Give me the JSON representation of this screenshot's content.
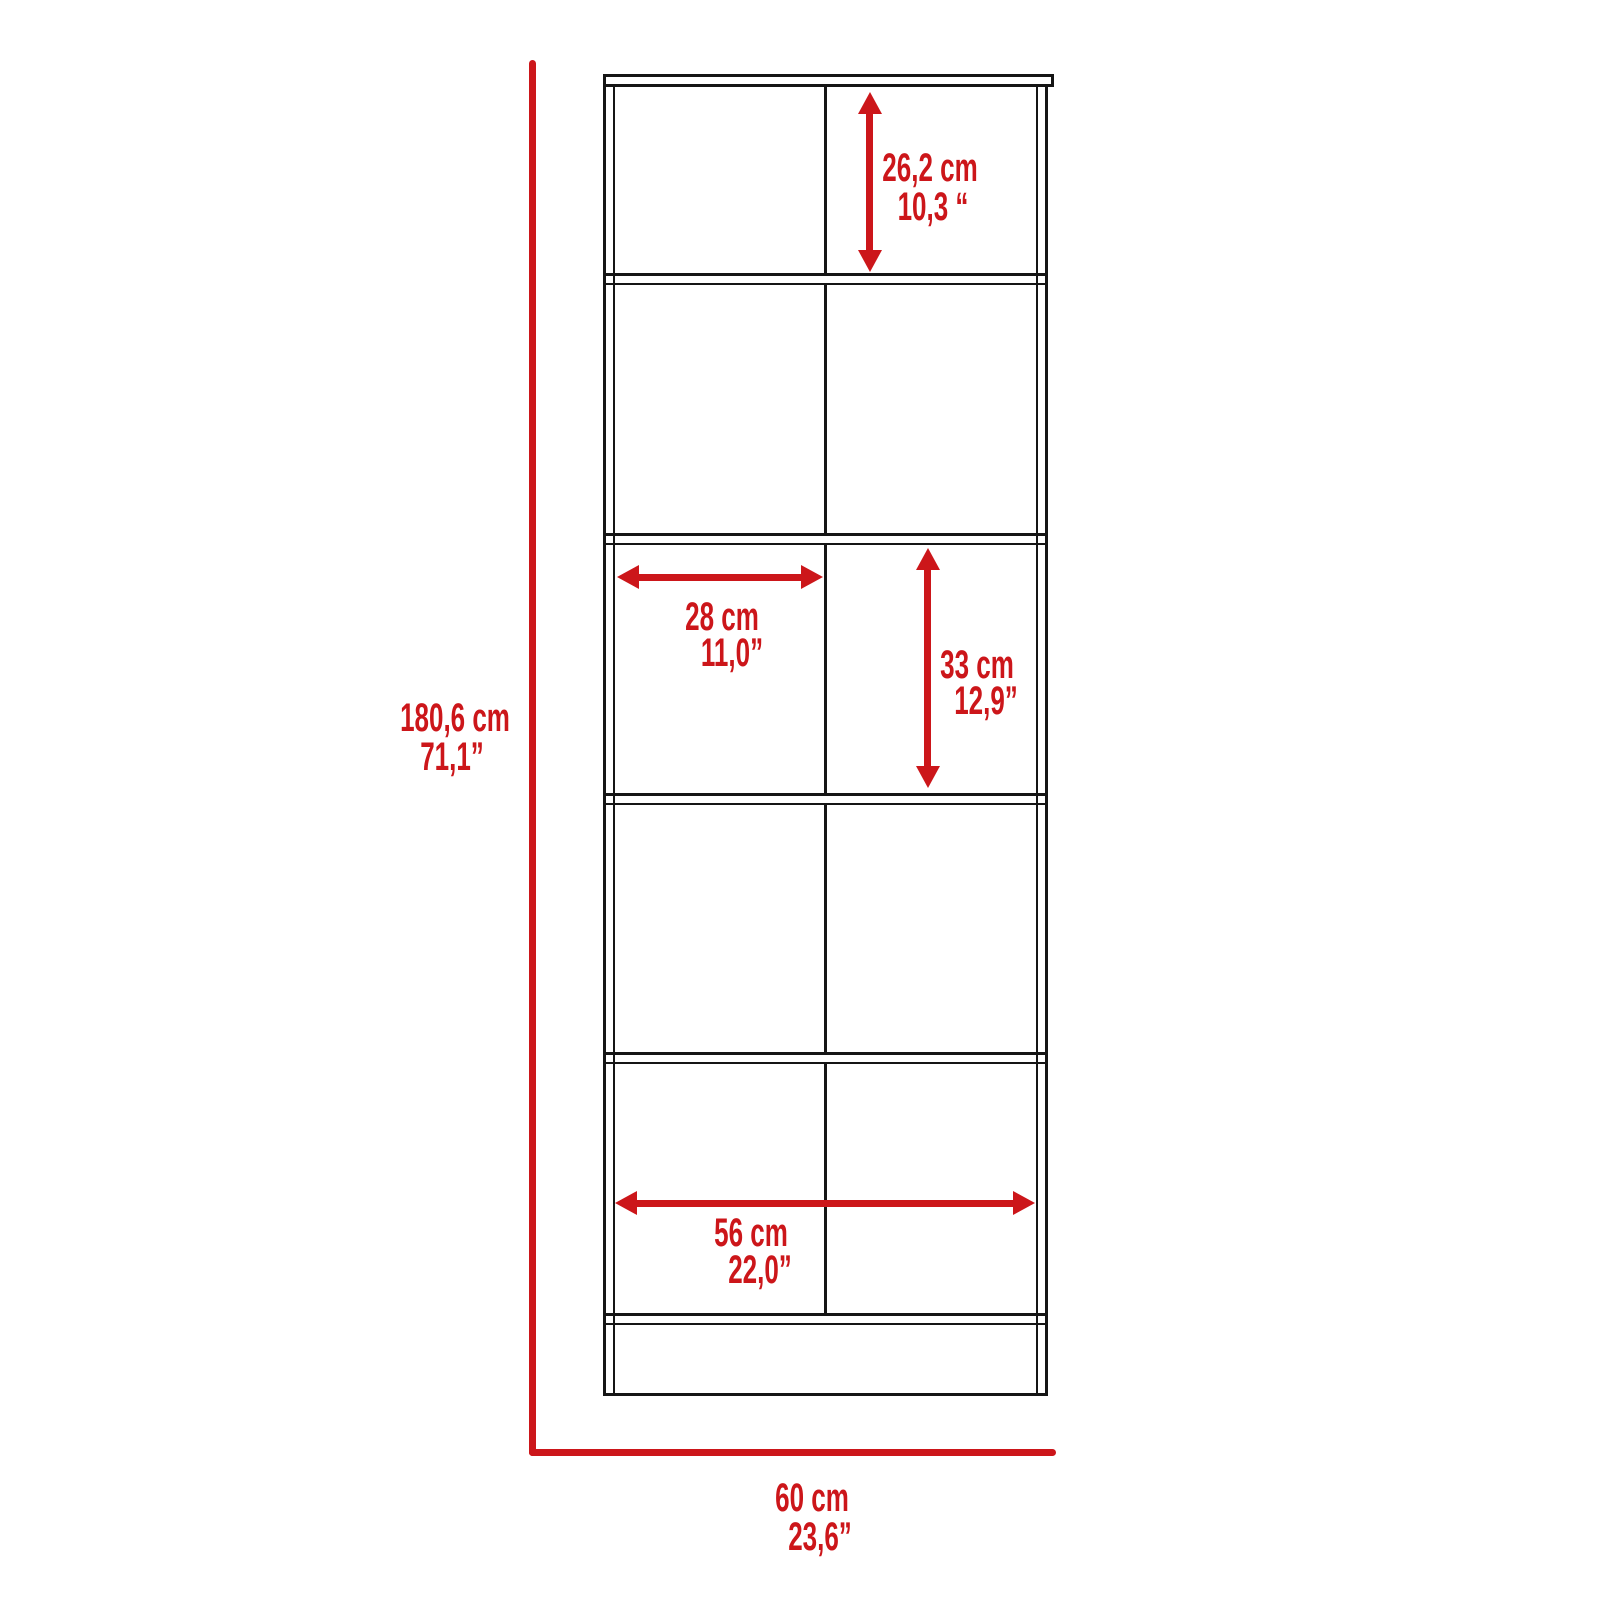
{
  "diagram": {
    "type": "furniture dimension diagram",
    "subject": "tall 10-cube storage bookcase, front elevation",
    "colors": {
      "dimension": "#cc161a",
      "outline": "#151515",
      "background": "#ffffff"
    },
    "dimensions": {
      "overall_height": {
        "cm": "180,6 cm",
        "inches": "71,1”"
      },
      "overall_width": {
        "cm": "60 cm",
        "inches": "23,6”"
      },
      "top_compartment_height": {
        "cm": "26,2 cm",
        "inches": "10,3 “"
      },
      "compartment_width": {
        "cm": "28 cm",
        "inches": "11,0”"
      },
      "compartment_height": {
        "cm": "33 cm",
        "inches": "12,9”"
      },
      "interior_width": {
        "cm": "56 cm",
        "inches": "22,0”"
      }
    }
  }
}
